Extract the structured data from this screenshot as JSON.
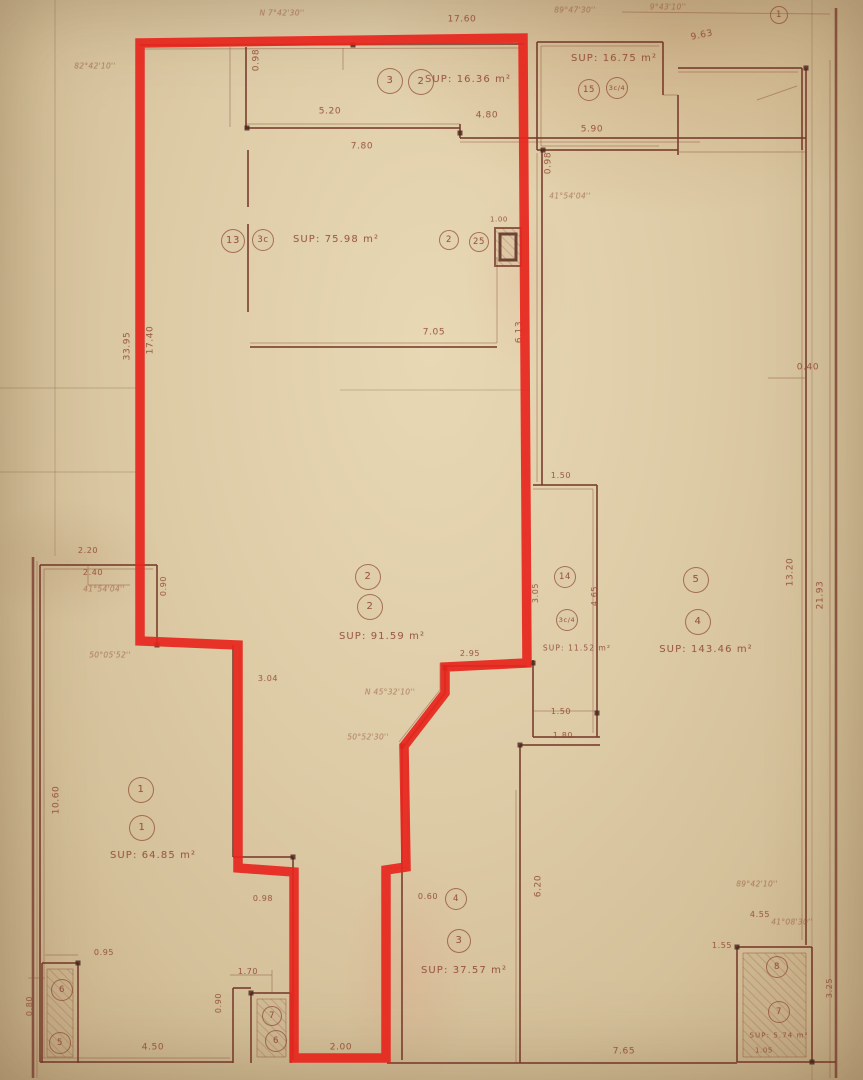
{
  "plan": {
    "kind": "scanned survey floor plan with highlighted parcel",
    "colors": {
      "paper": "#ddcba6",
      "ink": "#7a3f2e",
      "faint_ink": "#b5705e",
      "highlight": "#e8251d"
    },
    "unit_areas": [
      {
        "t": "SUP: 16.36 m²",
        "x": 468,
        "y": 80
      },
      {
        "t": "SUP: 16.75 m²",
        "x": 614,
        "y": 59
      },
      {
        "t": "SUP: 75.98 m²",
        "x": 336,
        "y": 240
      },
      {
        "t": "SUP: 91.59 m²",
        "x": 382,
        "y": 637
      },
      {
        "t": "SUP: 11.52 m²",
        "x": 577,
        "y": 648,
        "s": 7.5
      },
      {
        "t": "SUP: 143.46 m²",
        "x": 706,
        "y": 650
      },
      {
        "t": "SUP: 64.85 m²",
        "x": 153,
        "y": 856
      },
      {
        "t": "SUP: 37.57 m²",
        "x": 464,
        "y": 971
      },
      {
        "t": "SUP: 5.74 m²",
        "x": 779,
        "y": 1036,
        "s": 7
      }
    ],
    "unit_numbers": [
      {
        "n": "3",
        "x": 390,
        "y": 81
      },
      {
        "n": "2",
        "x": 421,
        "y": 82
      },
      {
        "n": "15",
        "x": 589,
        "y": 90,
        "d": 22
      },
      {
        "n": "3c/4",
        "x": 617,
        "y": 88,
        "d": 22
      },
      {
        "n": "13",
        "x": 233,
        "y": 241,
        "d": 24
      },
      {
        "n": "3c",
        "x": 263,
        "y": 240,
        "d": 22
      },
      {
        "n": "2",
        "x": 449,
        "y": 240,
        "d": 20
      },
      {
        "n": "25",
        "x": 479,
        "y": 242,
        "d": 20
      },
      {
        "n": "2",
        "x": 368,
        "y": 577
      },
      {
        "n": "2",
        "x": 370,
        "y": 607
      },
      {
        "n": "14",
        "x": 565,
        "y": 577,
        "d": 22
      },
      {
        "n": "3c/4",
        "x": 567,
        "y": 620,
        "d": 22
      },
      {
        "n": "5",
        "x": 696,
        "y": 580
      },
      {
        "n": "4",
        "x": 698,
        "y": 622
      },
      {
        "n": "1",
        "x": 141,
        "y": 790
      },
      {
        "n": "1",
        "x": 142,
        "y": 828
      },
      {
        "n": "4",
        "x": 456,
        "y": 899,
        "d": 22
      },
      {
        "n": "3",
        "x": 459,
        "y": 941,
        "d": 24
      },
      {
        "n": "6",
        "x": 62,
        "y": 990,
        "d": 22
      },
      {
        "n": "5",
        "x": 60,
        "y": 1043,
        "d": 22
      },
      {
        "n": "7",
        "x": 272,
        "y": 1016,
        "d": 20
      },
      {
        "n": "6",
        "x": 276,
        "y": 1041,
        "d": 22
      },
      {
        "n": "8",
        "x": 777,
        "y": 967,
        "d": 22
      },
      {
        "n": "7",
        "x": 779,
        "y": 1012,
        "d": 22
      },
      {
        "n": "1",
        "x": 779,
        "y": 15,
        "d": 18
      }
    ],
    "dimensions": [
      {
        "t": "17.60",
        "x": 462,
        "y": 20
      },
      {
        "t": "0.98",
        "x": 257,
        "y": 60,
        "r": -90
      },
      {
        "t": "5.20",
        "x": 330,
        "y": 112
      },
      {
        "t": "4.80",
        "x": 487,
        "y": 116
      },
      {
        "t": "7.80",
        "x": 362,
        "y": 147
      },
      {
        "t": "5.90",
        "x": 592,
        "y": 130
      },
      {
        "t": "9.63",
        "x": 702,
        "y": 36,
        "r": -12
      },
      {
        "t": "0.98",
        "x": 549,
        "y": 163,
        "r": -90
      },
      {
        "t": "0.40",
        "x": 808,
        "y": 368
      },
      {
        "t": "7.05",
        "x": 434,
        "y": 333
      },
      {
        "t": "1.00",
        "x": 499,
        "y": 220,
        "s": 7
      },
      {
        "t": "6.13",
        "x": 520,
        "y": 332,
        "r": -90
      },
      {
        "t": "17.40",
        "x": 151,
        "y": 340,
        "r": -90
      },
      {
        "t": "33.95",
        "x": 128,
        "y": 346,
        "r": -90
      },
      {
        "t": "1.50",
        "x": 561,
        "y": 476,
        "s": 8
      },
      {
        "t": "3.05",
        "x": 536,
        "y": 593,
        "r": -90,
        "s": 8
      },
      {
        "t": "4.65",
        "x": 595,
        "y": 596,
        "r": -90,
        "s": 8
      },
      {
        "t": "1.50",
        "x": 561,
        "y": 712,
        "s": 8
      },
      {
        "t": "1.80",
        "x": 563,
        "y": 736,
        "s": 8
      },
      {
        "t": "13.20",
        "x": 791,
        "y": 572,
        "r": -90
      },
      {
        "t": "21.93",
        "x": 821,
        "y": 595,
        "r": -90
      },
      {
        "t": "2.20",
        "x": 88,
        "y": 551,
        "s": 8
      },
      {
        "t": "2.40",
        "x": 93,
        "y": 573,
        "s": 8
      },
      {
        "t": "0.90",
        "x": 164,
        "y": 586,
        "r": -90,
        "s": 8
      },
      {
        "t": "3.04",
        "x": 268,
        "y": 679,
        "s": 8
      },
      {
        "t": "2.95",
        "x": 470,
        "y": 654,
        "s": 8
      },
      {
        "t": "10.60",
        "x": 57,
        "y": 800,
        "r": -90
      },
      {
        "t": "0.98",
        "x": 263,
        "y": 899,
        "s": 8
      },
      {
        "t": "0.60",
        "x": 428,
        "y": 897,
        "s": 8
      },
      {
        "t": "6.20",
        "x": 539,
        "y": 886,
        "r": -90
      },
      {
        "t": "1.70",
        "x": 248,
        "y": 972,
        "s": 8
      },
      {
        "t": "0.90",
        "x": 219,
        "y": 1003,
        "r": -90,
        "s": 8
      },
      {
        "t": "2.00",
        "x": 341,
        "y": 1048
      },
      {
        "t": "4.50",
        "x": 153,
        "y": 1048
      },
      {
        "t": "0.95",
        "x": 104,
        "y": 953,
        "s": 8
      },
      {
        "t": "7.65",
        "x": 624,
        "y": 1052
      },
      {
        "t": "1.55",
        "x": 722,
        "y": 946,
        "s": 8
      },
      {
        "t": "4.55",
        "x": 760,
        "y": 915,
        "s": 8
      },
      {
        "t": "3.25",
        "x": 830,
        "y": 988,
        "r": -90,
        "s": 8
      },
      {
        "t": "1.05",
        "x": 764,
        "y": 1051,
        "s": 7
      },
      {
        "t": "0.80",
        "x": 30,
        "y": 1006,
        "r": -90,
        "s": 8
      }
    ],
    "bearing_annotations": [
      {
        "t": "82°42'10''",
        "x": 95,
        "y": 66
      },
      {
        "t": "N 7°42'30''",
        "x": 282,
        "y": 13
      },
      {
        "t": "89°47'30''",
        "x": 575,
        "y": 10
      },
      {
        "t": "9°43'10''",
        "x": 668,
        "y": 7
      },
      {
        "t": "41°54'04''",
        "x": 570,
        "y": 196
      },
      {
        "t": "41°54'04''",
        "x": 104,
        "y": 589
      },
      {
        "t": "50°05'52''",
        "x": 110,
        "y": 655
      },
      {
        "t": "N 45°32'10''",
        "x": 390,
        "y": 692
      },
      {
        "t": "50°52'30''",
        "x": 368,
        "y": 737
      },
      {
        "t": "89°42'10''",
        "x": 757,
        "y": 884
      },
      {
        "t": "41°08'30''",
        "x": 792,
        "y": 922
      }
    ]
  }
}
